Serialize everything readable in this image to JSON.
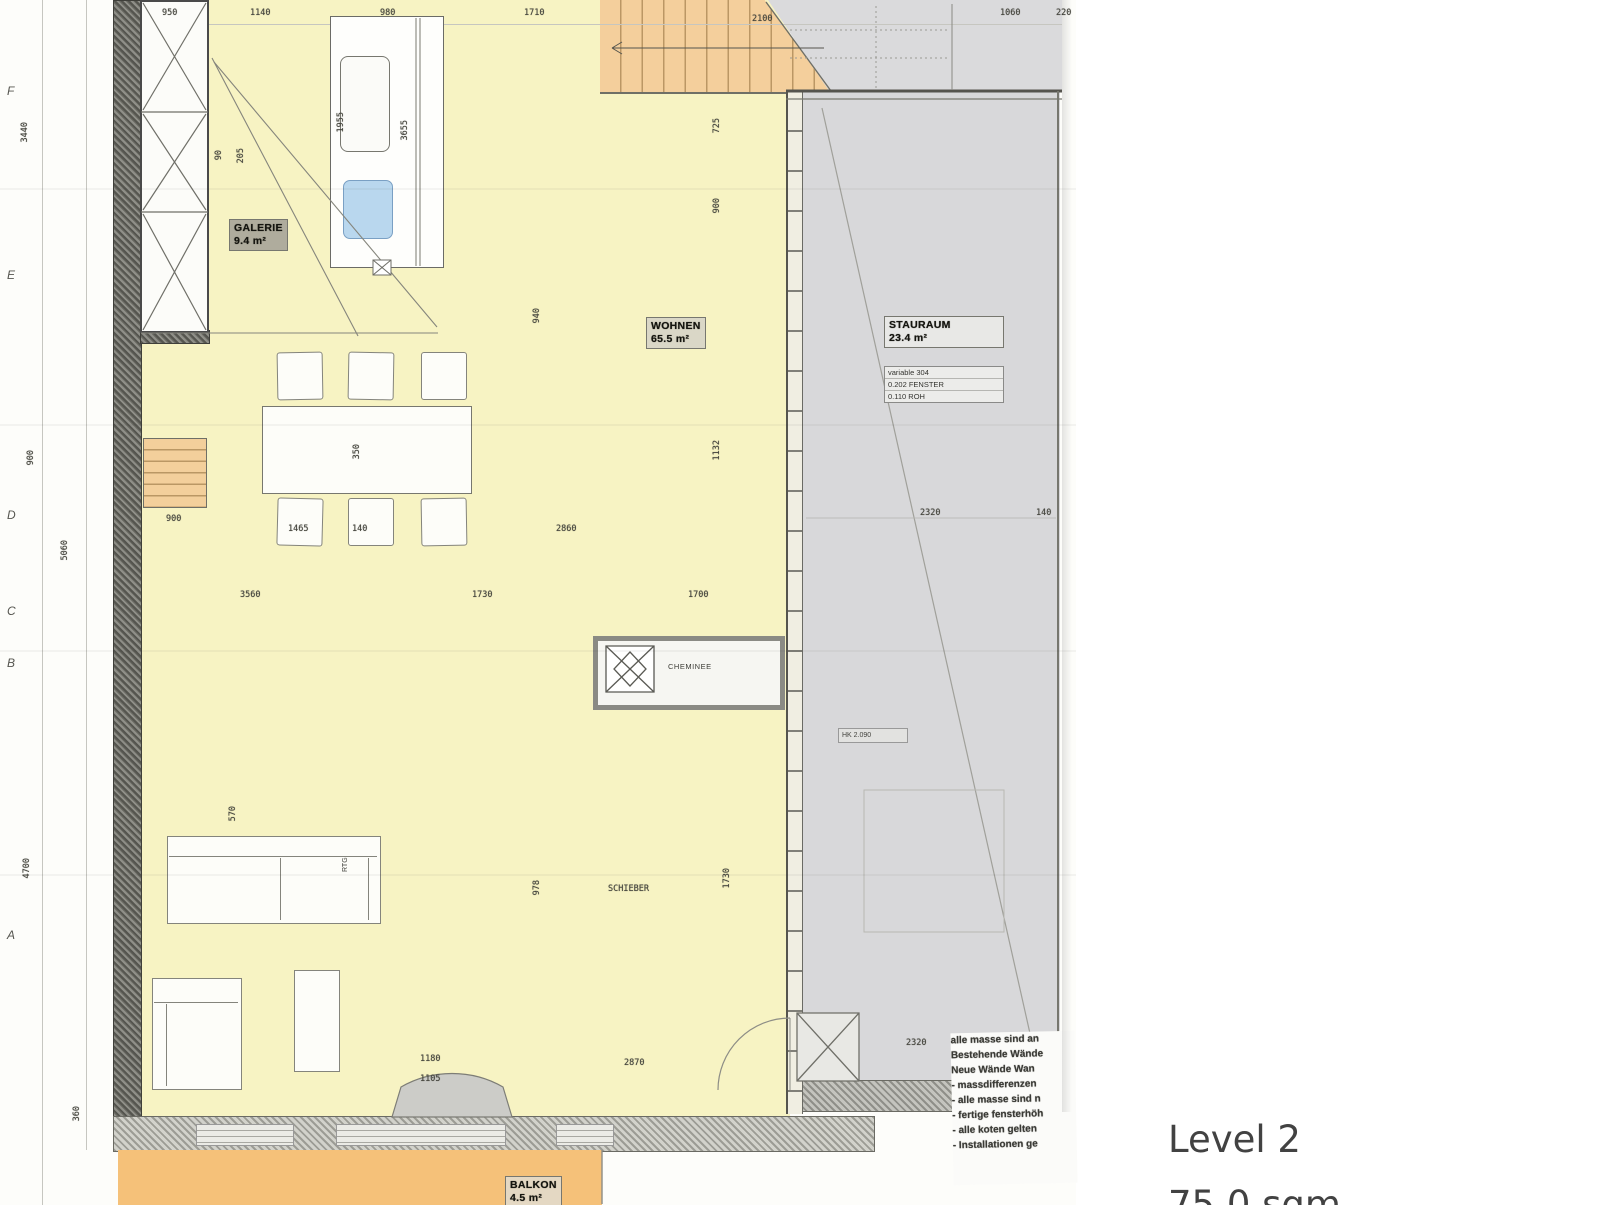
{
  "scan": {
    "rooms": {
      "galerie": {
        "name": "GALERIE",
        "area": "9.4 m²"
      },
      "wohnen": {
        "name": "WOHNEN",
        "area": "65.5 m²"
      },
      "stauraum": {
        "name": "STAURAUM",
        "area": "23.4 m²"
      },
      "balkon": {
        "name": "BALKON",
        "area": "4.5 m²"
      }
    },
    "fireplace_label": "CHEMINEE",
    "sofa_label": "RTG",
    "mini_label": "HK 2.090",
    "info_table": {
      "rows": [
        "variable 304",
        "0.202  FENSTER",
        "0.110  ROH"
      ]
    },
    "notes": {
      "lines": [
        "alle masse sind an",
        "Bestehende Wände",
        "Neue Wände Wan",
        "- massdifferenzen",
        "- alle masse sind n",
        "- fertige fensterhöh",
        "- alle koten gelten",
        "- Installationen ge"
      ]
    },
    "grid_letters": [
      {
        "t": "F",
        "y": 84
      },
      {
        "t": "E",
        "y": 268
      },
      {
        "t": "D",
        "y": 508
      },
      {
        "t": "C",
        "y": 604
      },
      {
        "t": "B",
        "y": 656
      },
      {
        "t": "A",
        "y": 928
      }
    ],
    "dimensions": [
      {
        "t": "950",
        "x": 162,
        "y": 8
      },
      {
        "t": "1140",
        "x": 250,
        "y": 8
      },
      {
        "t": "980",
        "x": 380,
        "y": 8
      },
      {
        "t": "1710",
        "x": 524,
        "y": 8
      },
      {
        "t": "2100",
        "x": 752,
        "y": 14
      },
      {
        "t": "1060",
        "x": 1000,
        "y": 8
      },
      {
        "t": "220",
        "x": 1056,
        "y": 8
      },
      {
        "t": "3440",
        "x": 20,
        "y": 122,
        "r": 90
      },
      {
        "t": "900",
        "x": 26,
        "y": 450,
        "r": 90
      },
      {
        "t": "5060",
        "x": 60,
        "y": 540,
        "r": 90
      },
      {
        "t": "4700",
        "x": 22,
        "y": 858,
        "r": 90
      },
      {
        "t": "360",
        "x": 72,
        "y": 1106,
        "r": 90
      },
      {
        "t": "90",
        "x": 214,
        "y": 150,
        "r": 90
      },
      {
        "t": "205",
        "x": 236,
        "y": 148,
        "r": 90
      },
      {
        "t": "1955",
        "x": 336,
        "y": 112,
        "r": 90
      },
      {
        "t": "3655",
        "x": 400,
        "y": 120,
        "r": 90
      },
      {
        "t": "725",
        "x": 712,
        "y": 118,
        "r": 90
      },
      {
        "t": "900",
        "x": 712,
        "y": 198,
        "r": 90
      },
      {
        "t": "940",
        "x": 532,
        "y": 308,
        "r": 90
      },
      {
        "t": "1132",
        "x": 712,
        "y": 440,
        "r": 90
      },
      {
        "t": "350",
        "x": 352,
        "y": 444,
        "r": 90
      },
      {
        "t": "900",
        "x": 166,
        "y": 514
      },
      {
        "t": "1465",
        "x": 288,
        "y": 524
      },
      {
        "t": "140",
        "x": 352,
        "y": 524
      },
      {
        "t": "2860",
        "x": 556,
        "y": 524
      },
      {
        "t": "3560",
        "x": 240,
        "y": 590
      },
      {
        "t": "1730",
        "x": 472,
        "y": 590
      },
      {
        "t": "1700",
        "x": 688,
        "y": 590
      },
      {
        "t": "570",
        "x": 228,
        "y": 806,
        "r": 90
      },
      {
        "t": "978",
        "x": 532,
        "y": 880,
        "r": 90
      },
      {
        "t": "1730",
        "x": 722,
        "y": 868,
        "r": 90
      },
      {
        "t": "SCHIEBER",
        "x": 608,
        "y": 884
      },
      {
        "t": "2320",
        "x": 920,
        "y": 508
      },
      {
        "t": "140",
        "x": 1036,
        "y": 508
      },
      {
        "t": "1180",
        "x": 420,
        "y": 1054
      },
      {
        "t": "1105",
        "x": 420,
        "y": 1074
      },
      {
        "t": "2870",
        "x": 624,
        "y": 1058
      },
      {
        "t": "2320",
        "x": 906,
        "y": 1038
      }
    ]
  },
  "footer": {
    "level": "Level 2",
    "area": "75.0 sqm"
  },
  "colors": {
    "room_yellow": "#f7f3c3",
    "stair_orange": "#f4cf9c",
    "balcony_orange": "#f5c179",
    "storage_gray": "#d8d8da",
    "sink_blue": "#b9d7ee",
    "wall_dark": "#55554f"
  }
}
